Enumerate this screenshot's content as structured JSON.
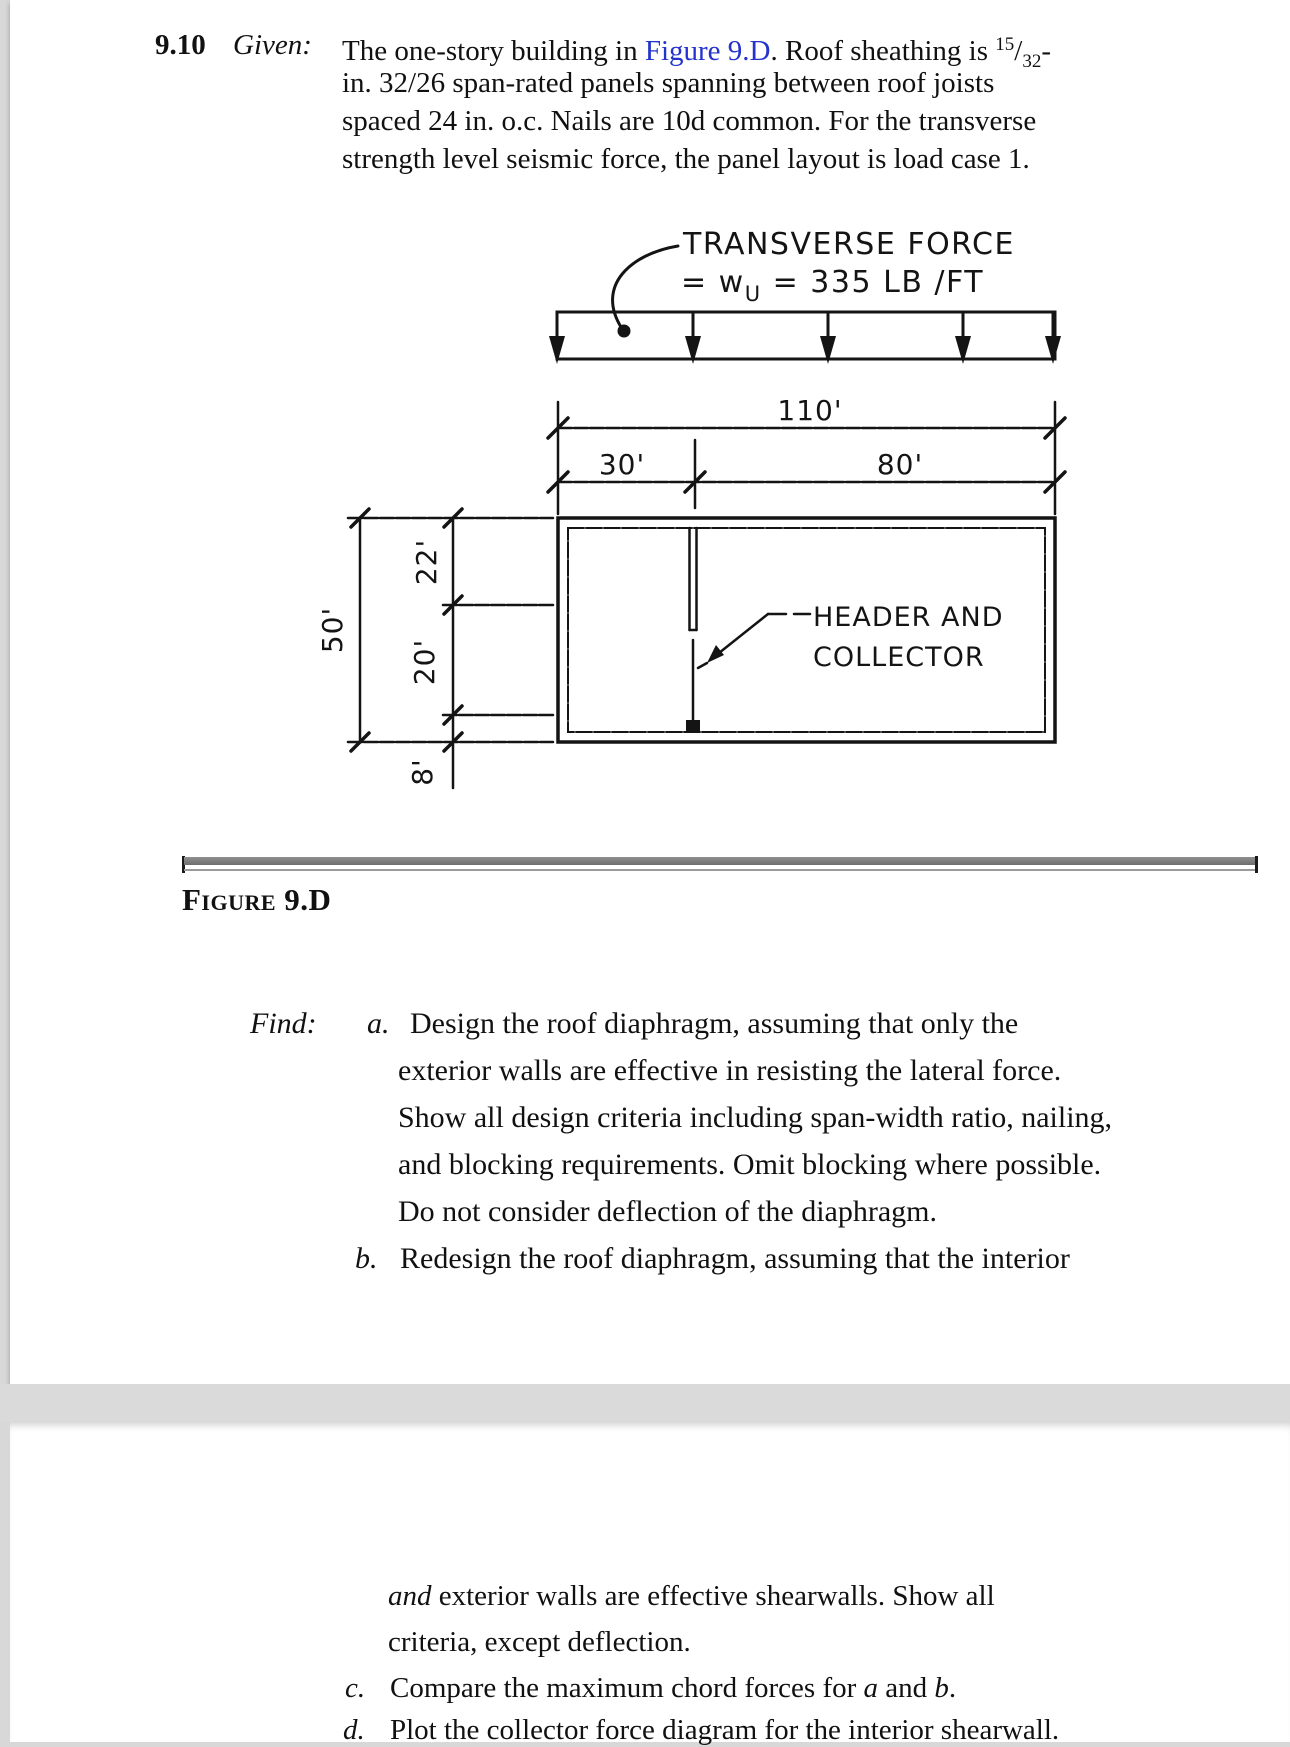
{
  "colors": {
    "link_blue": "#2333cc",
    "page_gap_gray": "#dadada",
    "divider_gray": "#6d6d6d"
  },
  "problem": {
    "number": "9.10",
    "given_label": "Given:",
    "line1_pre": "The one-story building in ",
    "line1_link": "Figure 9.D",
    "line1_post": ". Roof sheathing is ",
    "frac_sup": "15",
    "frac_slash": "/",
    "frac_sub": "32",
    "frac_dash": "-",
    "line2": "in. 32/26 span-rated panels spanning between roof joists",
    "line3": "spaced 24 in. o.c. Nails are 10d common. For the transverse",
    "line4": "strength level seismic force, the panel layout is load case 1."
  },
  "figure": {
    "caption": "Figure 9.D",
    "plan_label": "PLAN",
    "transverse_line1": "TRANSVERSE FORCE",
    "transverse_line2_pre": "= w",
    "transverse_sub": "U",
    "transverse_line2_post": " = 335 LB /FT",
    "dim_110": "110'",
    "dim_30": "30'",
    "dim_80": "80'",
    "dim_50": "50'",
    "dim_22": "22'",
    "dim_20": "20'",
    "dim_8": "8'",
    "header_label_line1": "HEADER AND",
    "header_label_line2": "COLLECTOR"
  },
  "find": {
    "label": "Find:",
    "a_marker": "a.",
    "a_lines": [
      "Design the roof diaphragm, assuming that only the",
      "exterior walls are effective in resisting the lateral force.",
      "Show all design criteria including span-width ratio, nailing,",
      "and blocking requirements. Omit blocking where possible.",
      "Do not consider deflection of the diaphragm."
    ],
    "b_marker": "b.",
    "b_line": "Redesign the roof diaphragm, assuming that the interior"
  },
  "page2": {
    "cont1_italic": "and",
    "cont1_rest": " exterior walls are effective shearwalls. Show all",
    "cont2": "criteria, except deflection.",
    "c_marker": "c.",
    "c_pre": "Compare the maximum chord forces for ",
    "c_a": "a",
    "c_mid": " and ",
    "c_b": "b",
    "c_post": ".",
    "d_marker": "d.",
    "d_text": "Plot the collector force diagram for the interior shearwall."
  }
}
